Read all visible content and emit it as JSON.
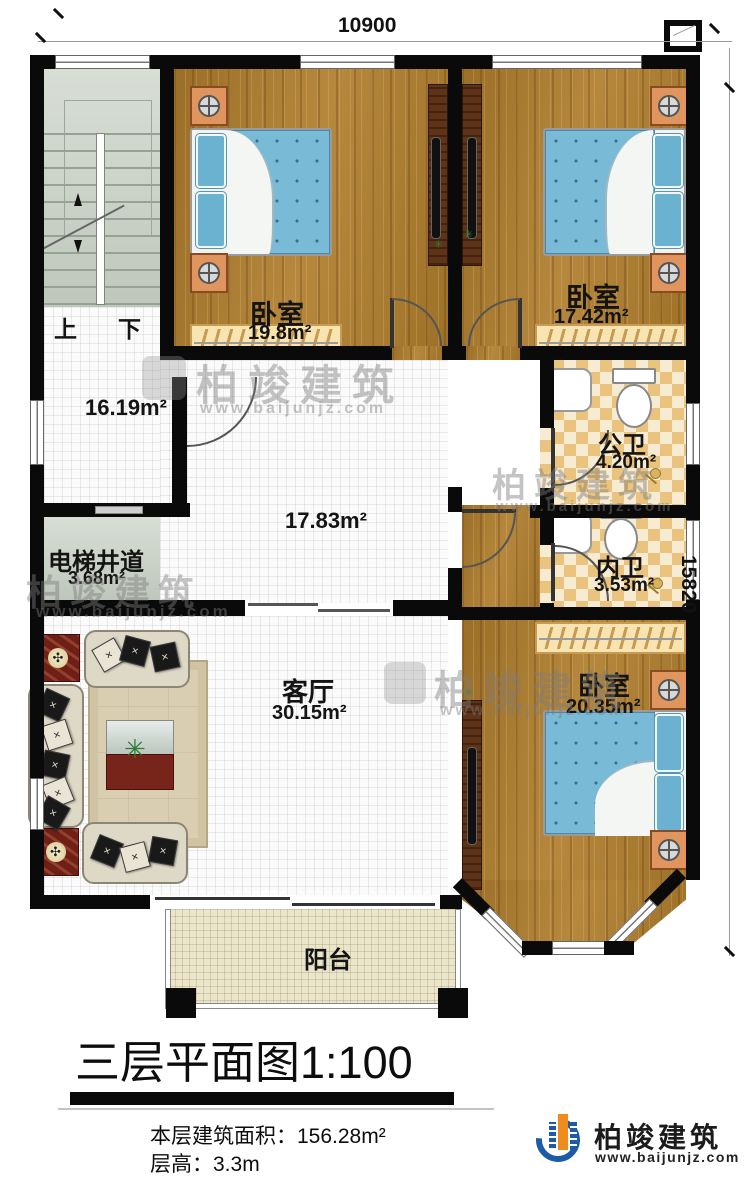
{
  "dimensions": {
    "width": "10900",
    "height": "15820"
  },
  "rooms": {
    "bedroom_top_left": {
      "label": "卧室",
      "area": "19.8m²"
    },
    "bedroom_top_right": {
      "label": "卧室",
      "area": "17.42m²"
    },
    "bedroom_bottom": {
      "label": "卧室",
      "area": "20.35m²"
    },
    "hall": {
      "area": "16.19m²"
    },
    "corridor": {
      "area": "17.83m²"
    },
    "bath_public": {
      "label": "公卫",
      "area": "4.20m²"
    },
    "bath_inner": {
      "label": "内卫",
      "area": "3.53m²"
    },
    "elevator": {
      "label": "电梯井道",
      "area": "3.68m²"
    },
    "living": {
      "label": "客厅",
      "area": "30.15m²"
    },
    "balcony": {
      "label": "阳台"
    }
  },
  "stairs": {
    "up": "上",
    "down": "下"
  },
  "titleblock": {
    "title": "三层平面图",
    "scale": "1:100"
  },
  "info": {
    "area_label": "本层建筑面积：",
    "area_value": "156.28m²",
    "height_label": "层高：",
    "height_value": "3.3m"
  },
  "brand": {
    "name": "柏竣建筑",
    "site": "www.baijunjz.com"
  },
  "colors": {
    "wall": "#0a0a0a",
    "wood": "#b07e2e",
    "bed": "#79bbd6",
    "brand_blue": "#1c5ca6",
    "brand_orange": "#f08c1e"
  }
}
